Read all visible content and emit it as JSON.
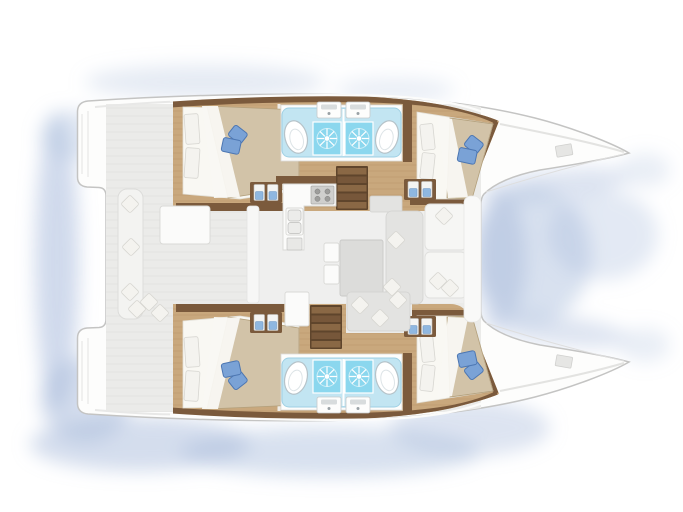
{
  "scene": {
    "subject": "catamaran-yacht-interior-floor-plan",
    "view": "top-down, bow pointing right",
    "hulls": [
      {
        "id": "port-hull",
        "position": "top",
        "spaces": [
          "aft-double-cabin",
          "aft-wet-room",
          "forward-wet-room",
          "forward-double-cabin",
          "companionway-stairs",
          "entry-steps"
        ]
      },
      {
        "id": "starboard-hull",
        "position": "bottom",
        "spaces": [
          "aft-double-cabin",
          "aft-wet-room",
          "forward-wet-room",
          "forward-double-cabin",
          "companionway-stairs",
          "entry-steps"
        ]
      }
    ],
    "bridge_deck": {
      "saloon": [
        "galley-counter",
        "stove",
        "double-sink",
        "dinette-table",
        "sofa",
        "forward-bench",
        "scatter-cushions"
      ],
      "cockpit": [
        "aft-bench-seat",
        "cockpit-table",
        "scatter-cushions",
        "sliding-door"
      ]
    },
    "exterior": [
      "twin-bow-decks-with-hatches",
      "stern-swim-platforms",
      "watercolor-water-shadow"
    ],
    "counts": {
      "cabins": 4,
      "wet_rooms": 4,
      "shower_sunbursts": 4,
      "toilets": 4,
      "wash_basins": 4,
      "blue_bed_cushion_sets": 4
    }
  },
  "palette": {
    "hull": "#fdfdfc",
    "outline": "#c4c4c3",
    "deck": "#ebebe9",
    "deck_line": "#e0e0de",
    "saloon_floor": "#efefee",
    "wood_floor": "#c9a87d",
    "wood_plank": "#b08c61",
    "wood_trim": "#7b5a3c",
    "stair_base": "#5f452c",
    "stair_tread": "#8a6845",
    "bed_duvet": "#d2c3a8",
    "duvet_edge": "#b3a07c",
    "bed_sheet": "#f9f8f3",
    "pillow_white": "#f4f3ef",
    "pillow_blue": "#7aa2d6",
    "pillow_blue_edge": "#4c76b2",
    "bath_counter": "#c2e5f2",
    "bath_counter_edge": "#9ed0e4",
    "shower_blue": "#8bd7ee",
    "toilet_edge": "#b6c3c9",
    "furniture_gray": "#e3e3e1",
    "furniture_edge": "#d2d2d0",
    "table_gray": "#dcdcda",
    "water_shadow": "#a9bcdc"
  }
}
